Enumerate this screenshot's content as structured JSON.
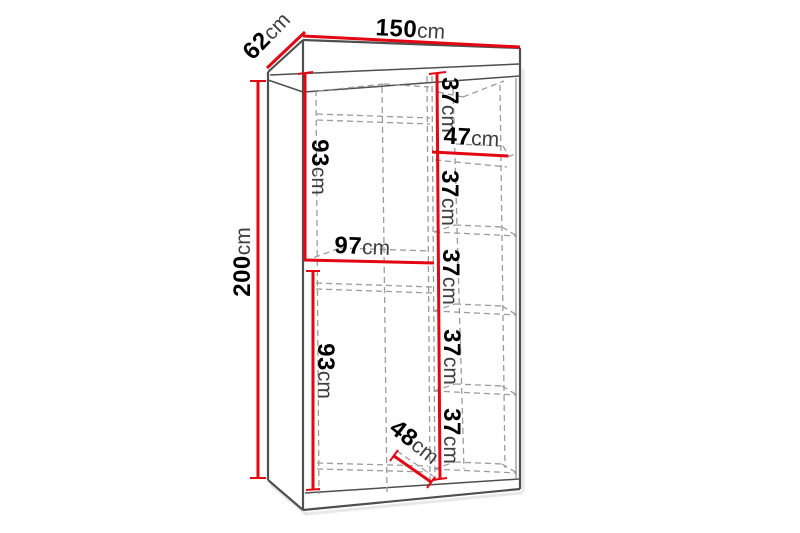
{
  "diagram": {
    "type": "wardrobe-dimension-diagram",
    "background": "#ffffff",
    "colors": {
      "dimension": "#e30613",
      "outline": "#4f4f4f",
      "hidden": "#9b9b9b",
      "number": "#000000",
      "unit": "#3f3f3f",
      "shadow": "#d6d6d6"
    },
    "labels": {
      "width": {
        "value": "150",
        "unit": "cm"
      },
      "depth": {
        "value": "62",
        "unit": "cm"
      },
      "height": {
        "value": "200",
        "unit": "cm"
      },
      "upper_section_height": {
        "value": "93",
        "unit": "cm"
      },
      "left_compartment_width": {
        "value": "97",
        "unit": "cm"
      },
      "lower_section_height": {
        "value": "93",
        "unit": "cm"
      },
      "right_compartment_width": {
        "value": "47",
        "unit": "cm"
      },
      "interior_depth": {
        "value": "48",
        "unit": "cm"
      },
      "shelf_spacing_1": {
        "value": "37",
        "unit": "cm"
      },
      "shelf_spacing_2": {
        "value": "37",
        "unit": "cm"
      },
      "shelf_spacing_3": {
        "value": "37",
        "unit": "cm"
      },
      "shelf_spacing_4": {
        "value": "37",
        "unit": "cm"
      },
      "shelf_spacing_5": {
        "value": "37",
        "unit": "cm"
      }
    }
  }
}
